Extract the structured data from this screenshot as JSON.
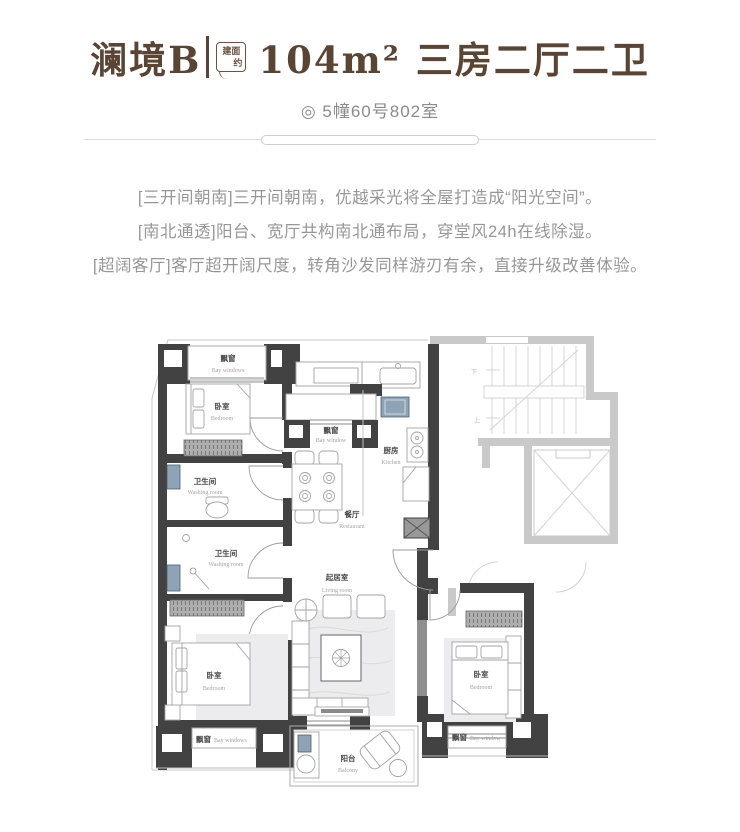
{
  "header": {
    "project": "澜境B",
    "badge_line1": "建面",
    "badge_line2": "约",
    "title": "104m² 三房二厅二卫",
    "subtitle": "◎ 5幢60号802室"
  },
  "description": {
    "lines": [
      "[三开间朝南]三开间朝南，优越采光将全屋打造成“阳光空间”。",
      "[南北通透]阳台、宽厅共构南北通布局，穿堂风24h在线除湿。",
      "[超阔客厅]客厅超开阔尺度，转角沙发同样游刃有余，直接升级改善体验。"
    ]
  },
  "floorplan": {
    "rooms": {
      "bay_top": {
        "zh": "飘窗",
        "en": "Bay windows"
      },
      "bedroom_nw": {
        "zh": "卧室",
        "en": "Bedroom"
      },
      "bath_upper": {
        "zh": "卫生间",
        "en": "Washing room"
      },
      "bath_lower": {
        "zh": "卫生间",
        "en": "Washing room"
      },
      "bedroom_sw": {
        "zh": "卧室",
        "en": "Bedroom"
      },
      "bay_sw": {
        "zh": "飘窗",
        "en": "Bay windows"
      },
      "bay_mid": {
        "zh": "飘窗",
        "en": "Bay window"
      },
      "dining": {
        "zh": "餐厅",
        "en": "Restaurant"
      },
      "kitchen": {
        "zh": "厨房",
        "en": "Kitchen"
      },
      "living": {
        "zh": "起居室",
        "en": "Living room"
      },
      "balcony": {
        "zh": "阳台",
        "en": "Balcony"
      },
      "bedroom_se": {
        "zh": "卧室",
        "en": "Bedroom"
      },
      "bay_se": {
        "zh": "飘窗",
        "en": "Bay window"
      }
    },
    "core": {
      "up": "上",
      "down": "下"
    },
    "colors": {
      "accent_brown": "#5a4433",
      "wall_dark": "#424242",
      "wall_ghost": "#c9c9c9",
      "fixture_blue": "#8fa3b6",
      "text_gray": "#979797"
    }
  }
}
